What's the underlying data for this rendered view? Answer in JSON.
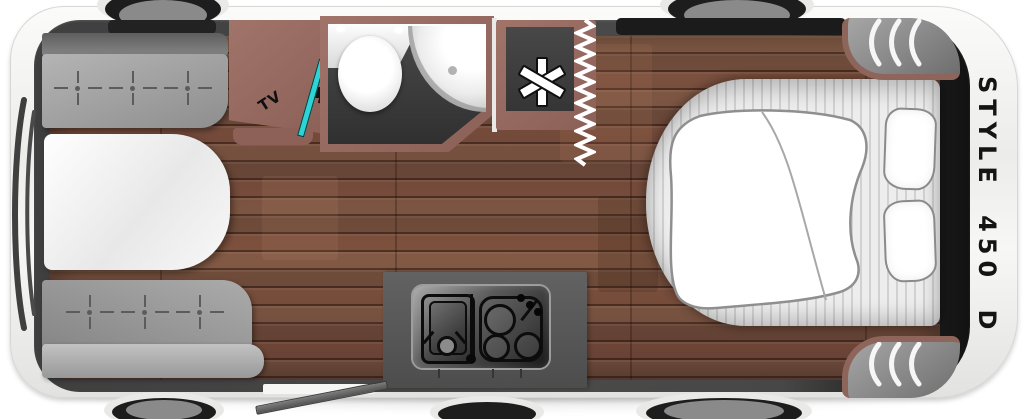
{
  "floorplan": {
    "model_label": "STYLE 450 D",
    "tv_label": "TV",
    "elements": [
      "dinette-bench-front",
      "dinette-bench-rear",
      "dinette-table",
      "tv-cabinet",
      "bathroom",
      "toilet",
      "corner-washbasin",
      "refrigerator-asterisk-symbol",
      "entry-zigzag",
      "entry-door-open",
      "kitchen-counter",
      "kitchen-sink",
      "hob-3-burner",
      "double-bed",
      "duvet",
      "pillow",
      "pillow",
      "heater-vent-front-top",
      "heater-vent-front-bottom",
      "wheel",
      "rear-window"
    ],
    "colors": {
      "body_white": "#f3f3f1",
      "wall_dark": "#474747",
      "wood_floor": "#75503f",
      "furniture_mauve": "#936960",
      "bench_gray": "#9e9e9e",
      "tv_screen_cyan": "#2ed3d6",
      "kitchen_counter": "#585858",
      "bathroom_floor": "#3d3d3d",
      "label_black": "#141414"
    }
  }
}
